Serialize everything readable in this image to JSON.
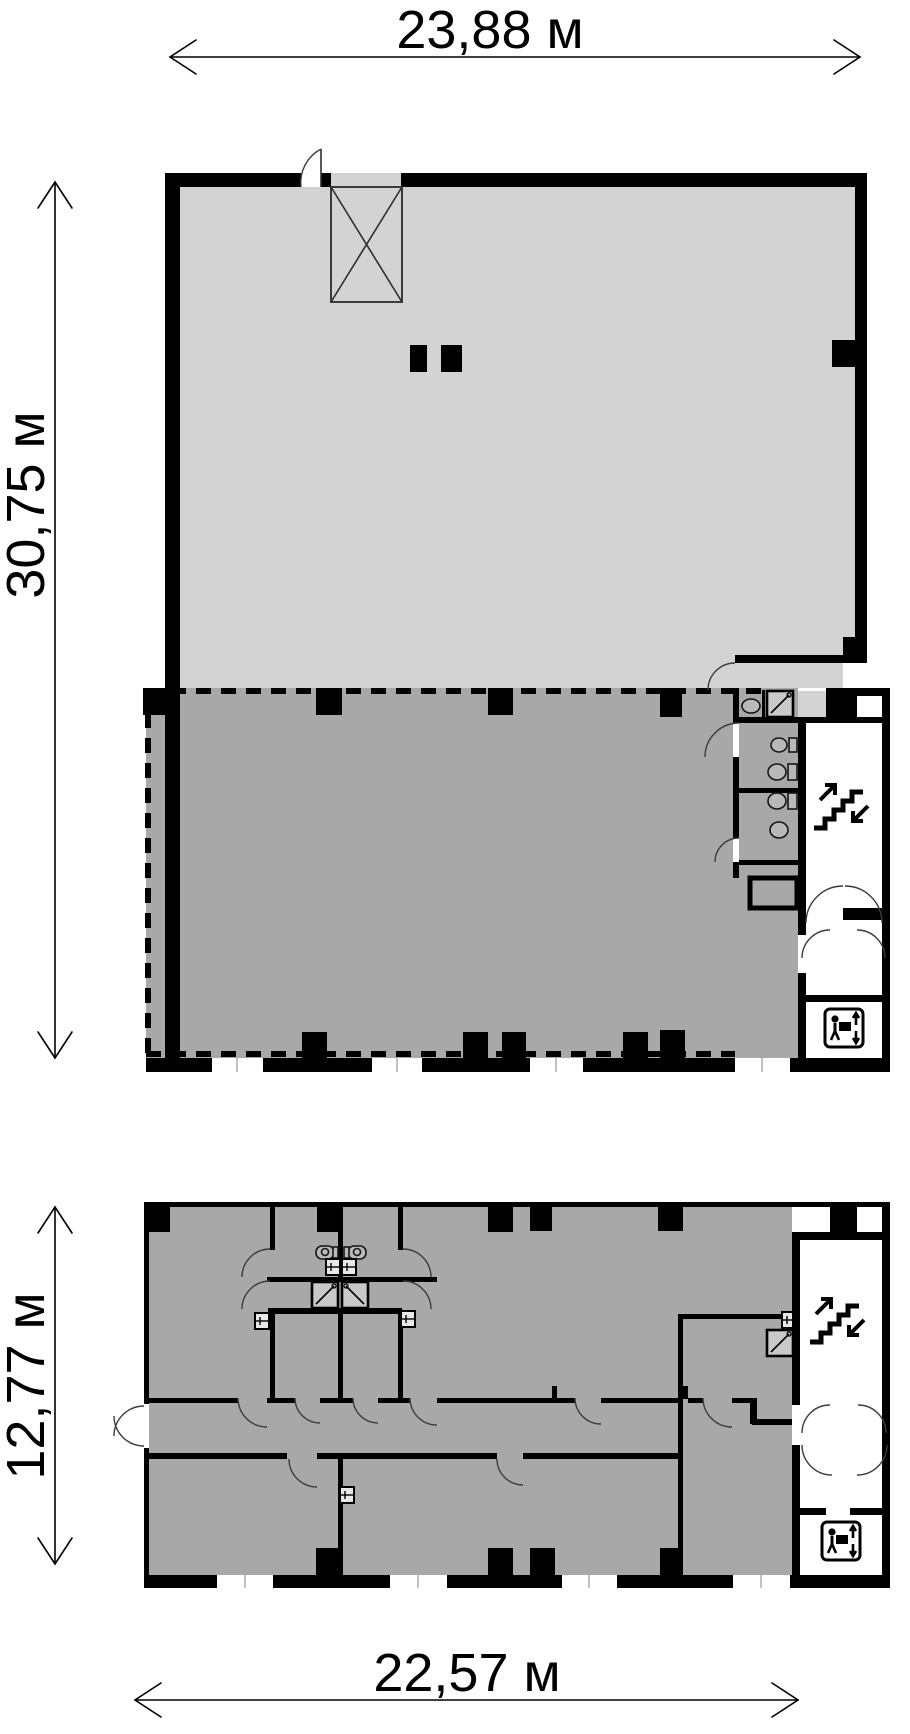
{
  "dimensions": {
    "upper_plan_width": "23,88 м",
    "upper_plan_height": "30,75 м",
    "lower_plan_height": "12,77 м",
    "lower_plan_width": "22,57 м"
  },
  "plans": {
    "upper": {
      "zones": [
        {
          "name": "open-light-zone",
          "color": "#d3d3d3"
        },
        {
          "name": "selected-dark-zone",
          "color": "#a8a8a8",
          "boundary": "dashed"
        }
      ],
      "features": [
        "ventilation-shaft-x",
        "washrooms",
        "elevator-shaft",
        "stairwell",
        "freight-elevator-room",
        "entrance-lobby"
      ]
    },
    "lower": {
      "zones": [
        {
          "name": "selected-dark-zone",
          "color": "#a8a8a8"
        }
      ],
      "features": [
        "wc-core",
        "twin-elevator-shafts",
        "corridor",
        "stairwell",
        "freight-elevator-room",
        "entrance-lobby"
      ]
    }
  },
  "icons": {
    "stairs": "stairs-up-down-arrows",
    "freight_elevator": "person-with-box-up-down-arrows",
    "elevator": "square-with-diagonal",
    "fixtures": [
      "toilet",
      "sink",
      "radiator-cross-box"
    ]
  },
  "colors": {
    "wall": "#000000",
    "light_zone": "#d3d3d3",
    "dark_zone": "#a8a8a8",
    "background": "#ffffff"
  }
}
